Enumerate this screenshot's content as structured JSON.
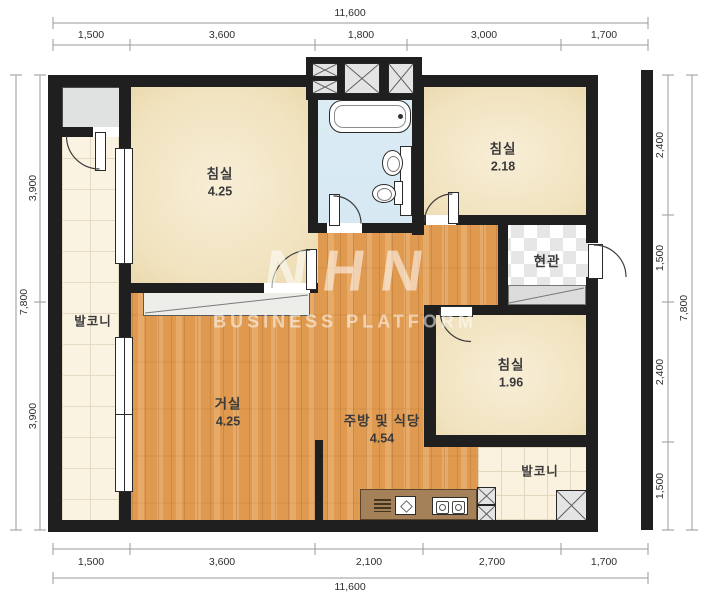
{
  "plan": {
    "watermark": {
      "logo": "NHN",
      "subtitle": "BUSINESS PLATFORM"
    },
    "rooms": [
      {
        "key": "bedroom-1",
        "name": "침실",
        "area": "4.25"
      },
      {
        "key": "bedroom-2",
        "name": "침실",
        "area": "2.18"
      },
      {
        "key": "bedroom-3",
        "name": "침실",
        "area": "1.96"
      },
      {
        "key": "living-room",
        "name": "거실",
        "area": "4.25"
      },
      {
        "key": "kitchen-dining",
        "name": "주방 및 식당",
        "area": "4.54"
      },
      {
        "key": "entrance",
        "name": "현관"
      },
      {
        "key": "balcony-left",
        "name": "발코니"
      },
      {
        "key": "balcony-bottom",
        "name": "발코니"
      }
    ],
    "dimensions": {
      "top": {
        "total": "11,600",
        "segments": [
          "1,500",
          "3,600",
          "1,800",
          "3,000",
          "1,700"
        ]
      },
      "bottom": {
        "total": "11,600",
        "segments": [
          "1,500",
          "3,600",
          "2,100",
          "2,700",
          "1,700"
        ]
      },
      "left": {
        "total": "7,800",
        "segments": [
          "3,900",
          "3,900"
        ]
      },
      "right": {
        "total": "7,800",
        "segments": [
          "2,400",
          "1,500",
          "2,400",
          "1,500"
        ]
      }
    },
    "colors": {
      "wall": "#1f1f1f",
      "wood": "#e09a50",
      "bedroom": "#f2e4c2",
      "bathroom": "#d9eaf3",
      "tile": "#fbf3e2",
      "counter": "#a5815a"
    }
  }
}
